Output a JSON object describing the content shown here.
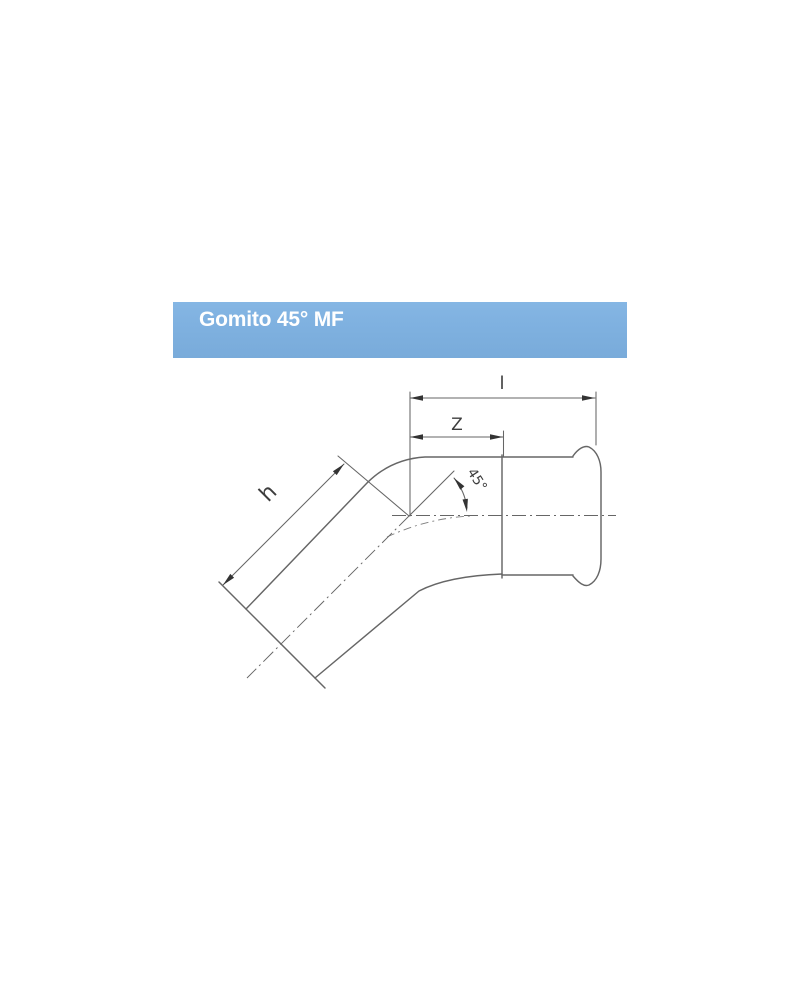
{
  "header": {
    "title": "Gomito 45° MF"
  },
  "diagram": {
    "type": "technical-drawing",
    "description": "Side view of a 45 degree elbow press fitting with plain male end and female press socket",
    "labels": {
      "overall_length": "l",
      "insertion_depth": "Z",
      "male_end_length": "h",
      "bend_angle": "45°"
    }
  },
  "colors": {
    "header_bg": "#7fb1e0",
    "header_text": "#ffffff",
    "line": "#666666",
    "arrow": "#333333",
    "label": "#3d3d3d",
    "page_bg": "#ffffff"
  }
}
